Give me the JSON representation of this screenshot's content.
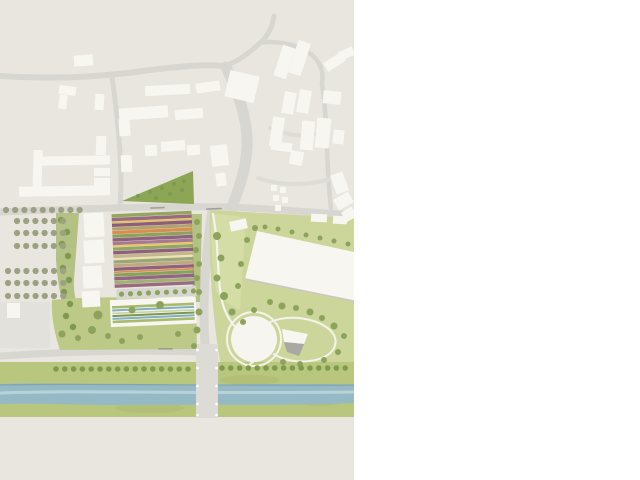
{
  "meta": {
    "kind": "architectural-site-plan",
    "plan_area": {
      "width_px": 354,
      "height_px": 480
    },
    "page_margin_color": "#ffffff"
  },
  "palette": {
    "ground_beige": "#e9e6df",
    "road_gray": "#d8d6d1",
    "road_faint": "#dedcd6",
    "building_white": "#f8f6f0",
    "building_shadow": "#c9c7c0",
    "plaza_light": "#e3e1db",
    "lawn_green": "#ccd69b",
    "lawn_pale": "#d4dda6",
    "hill_green": "#bcc987",
    "corridor_green": "#b9c77e",
    "corridor_mottle": "#a6b569",
    "strip_green": "#b3c183",
    "triangle_green": "#8ca656",
    "tree_olive": "#8da35c",
    "tree_dark": "#7f9a4f",
    "tree_gray": "#9ba182",
    "river_blue": "#95bac5",
    "river_light": "#b9d2d8",
    "river_dark_edge": "#7fa3b0",
    "bridge_gray": "#dcdbd6",
    "circle_white": "#f6f5ef",
    "path_white": "#f4f3ec",
    "pavilion_gray": "#a9a8a3",
    "pergola_gray": "#d8d6d1",
    "label_gray": "#97948e"
  },
  "field": {
    "name": "striped-crop-field",
    "stripes": [
      {
        "c": "#95a55e",
        "h": 3.3
      },
      {
        "c": "#9a6b80",
        "h": 3.5
      },
      {
        "c": "#e4bf50",
        "h": 1.6
      },
      {
        "c": "#8d5e79",
        "h": 3.4
      },
      {
        "c": "#b2a26e",
        "h": 3.2
      },
      {
        "c": "#d88e4e",
        "h": 3.3
      },
      {
        "c": "#8ca25a",
        "h": 3.3
      },
      {
        "c": "#90617e",
        "h": 3.4
      },
      {
        "c": "#a87a92",
        "h": 3.2
      },
      {
        "c": "#edc553",
        "h": 1.6
      },
      {
        "c": "#94a664",
        "h": 3.3
      },
      {
        "c": "#8e6080",
        "h": 3.4
      },
      {
        "c": "#c4b88b",
        "h": 3.2
      },
      {
        "c": "#f1e2a8",
        "h": 1.6
      },
      {
        "c": "#99a77a",
        "h": 3.3
      },
      {
        "c": "#c1a87d",
        "h": 3.2
      },
      {
        "c": "#92617d",
        "h": 3.4
      },
      {
        "c": "#d8914e",
        "h": 1.8
      },
      {
        "c": "#89a25b",
        "h": 3.3
      },
      {
        "c": "#916583",
        "h": 3.4
      },
      {
        "c": "#a4af76",
        "h": 3.3
      },
      {
        "c": "#9a6b80",
        "h": 3.4
      }
    ]
  },
  "greenhouse": {
    "name": "greenhouse-building",
    "stripes": [
      {
        "dy": 6.0,
        "h": 2.6,
        "c": "#a9b96d"
      },
      {
        "dy": 9.4,
        "h": 2.0,
        "c": "#7fb0c3"
      },
      {
        "dy": 12.6,
        "h": 1.6,
        "c": "#c8d2a0"
      },
      {
        "dy": 15.0,
        "h": 2.0,
        "c": "#7d9551"
      },
      {
        "dy": 17.8,
        "h": 2.0,
        "c": "#7fb0c3"
      },
      {
        "dy": 20.6,
        "h": 2.6,
        "c": "#a9b96d"
      }
    ]
  },
  "street_labels": {
    "note": "three tiny illegible street-name marks",
    "count": 3
  }
}
